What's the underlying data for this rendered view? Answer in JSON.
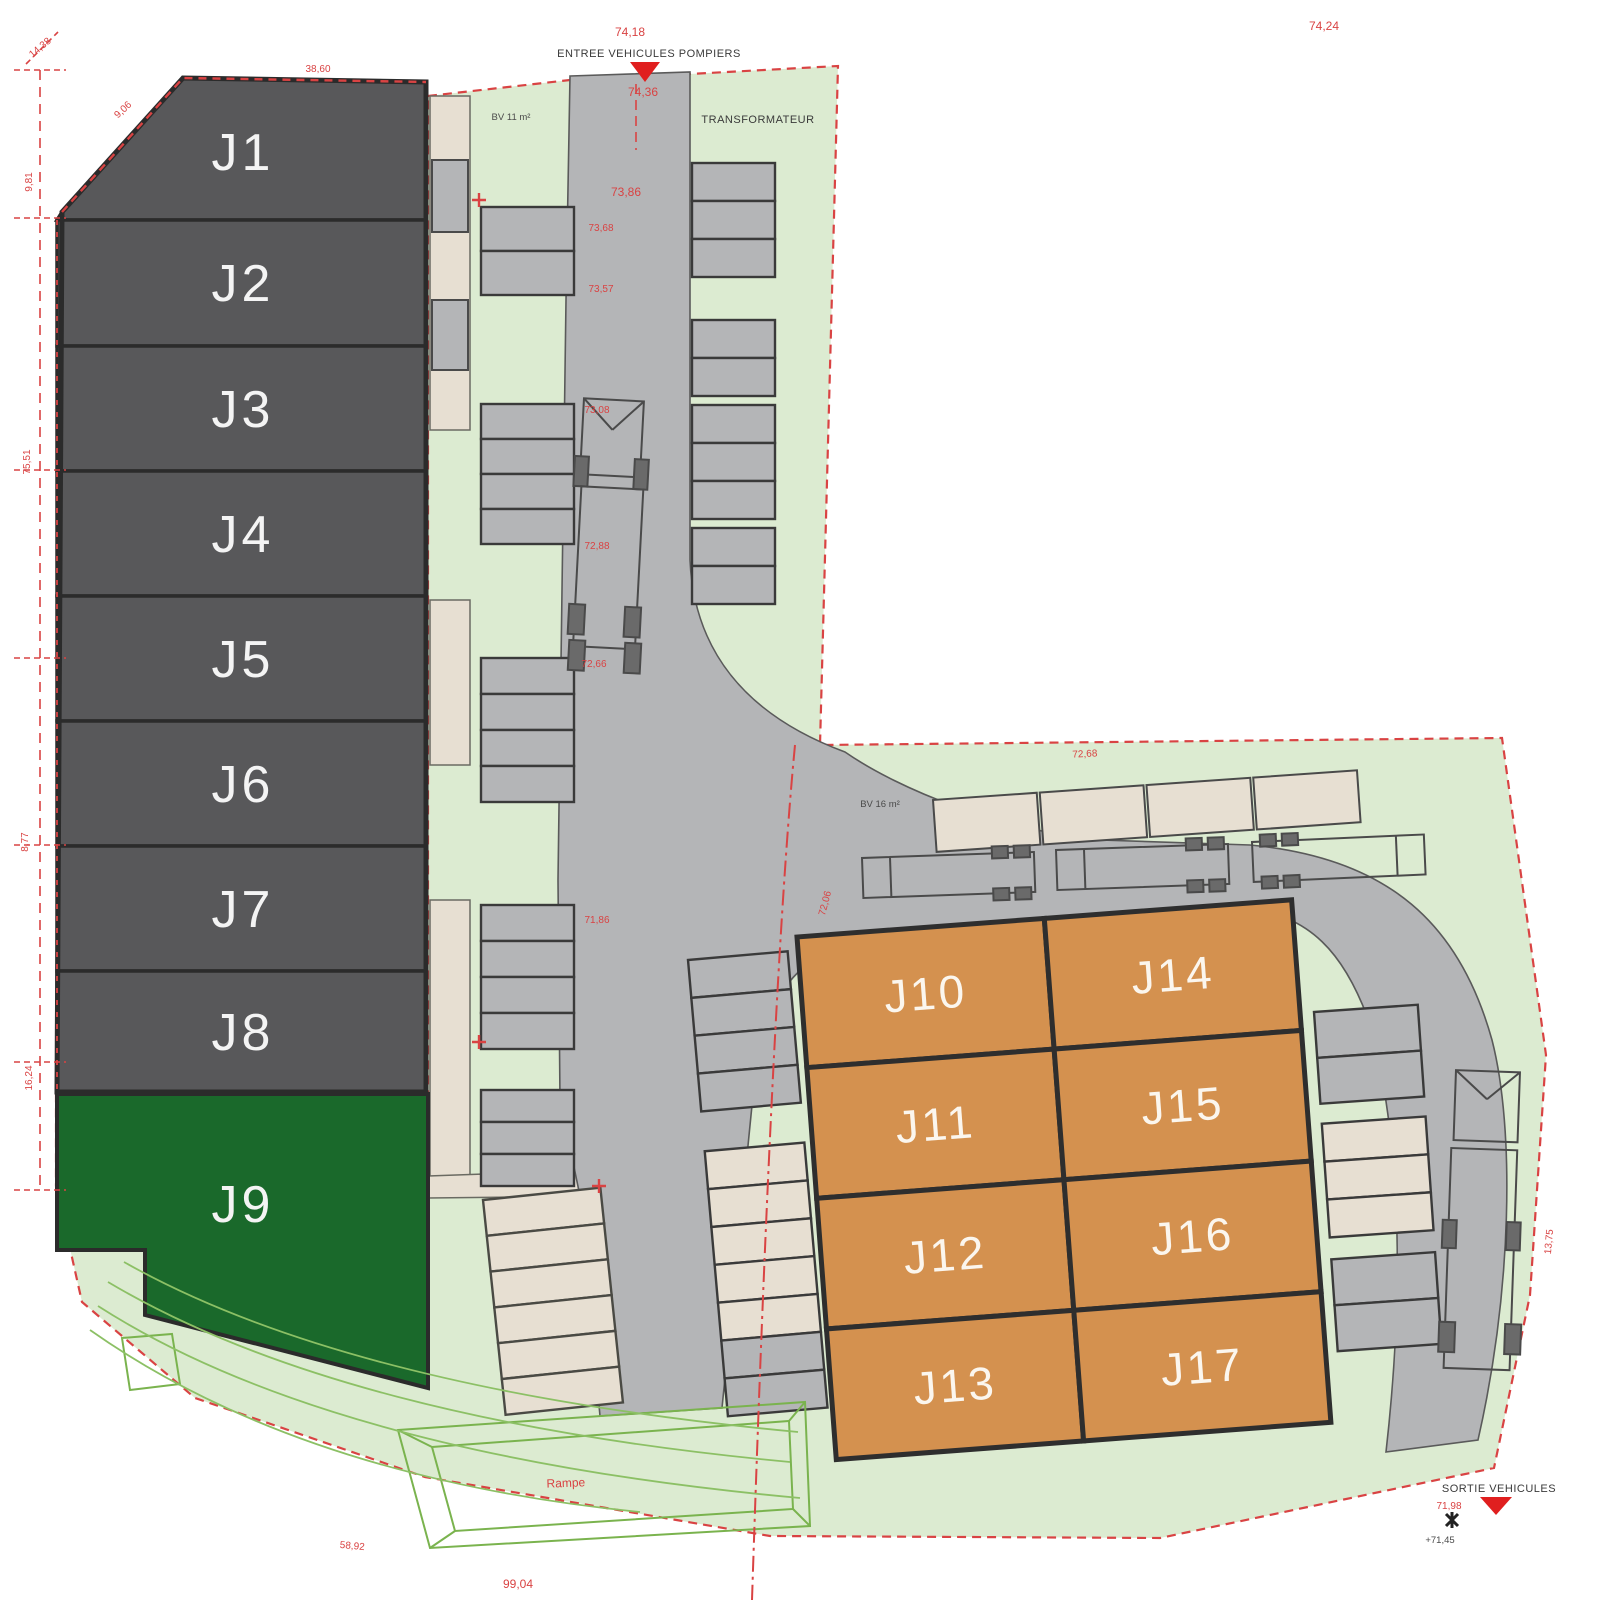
{
  "building": {
    "units": [
      {
        "id": "J1"
      },
      {
        "id": "J2"
      },
      {
        "id": "J3"
      },
      {
        "id": "J4"
      },
      {
        "id": "J5"
      },
      {
        "id": "J6"
      },
      {
        "id": "J7"
      },
      {
        "id": "J8"
      }
    ]
  },
  "green_lot": {
    "id": "J9"
  },
  "plots": [
    {
      "id": "J10"
    },
    {
      "id": "J11"
    },
    {
      "id": "J12"
    },
    {
      "id": "J13"
    },
    {
      "id": "J14"
    },
    {
      "id": "J15"
    },
    {
      "id": "J16"
    },
    {
      "id": "J17"
    }
  ],
  "markers": {
    "entry": {
      "label": "ENTREE VEHICULES POMPIERS"
    },
    "exit": {
      "label": "SORTIE VEHICULES",
      "level": "+71,45"
    }
  },
  "site_labels": {
    "transformer": "TRANSFORMATEUR",
    "utility_left": "BV 11 m²",
    "utility_dock": "BV 16 m²"
  },
  "dimensions": [
    {
      "text": "74,18"
    },
    {
      "text": "74,36"
    },
    {
      "text": "74,24"
    },
    {
      "text": "73,86"
    },
    {
      "text": "73,68"
    },
    {
      "text": "73,57"
    },
    {
      "text": "73,08"
    },
    {
      "text": "72,88"
    },
    {
      "text": "72,66"
    },
    {
      "text": "71,86"
    },
    {
      "text": "72,06"
    },
    {
      "text": "72,68"
    },
    {
      "text": "14,38"
    },
    {
      "text": "9,06"
    },
    {
      "text": "38,60"
    },
    {
      "text": "9,81"
    },
    {
      "text": "75,51"
    },
    {
      "text": "8,77"
    },
    {
      "text": "16,24"
    },
    {
      "text": "99,04"
    },
    {
      "text": "Rampe"
    },
    {
      "text": "58,92"
    },
    {
      "text": "13,75"
    },
    {
      "text": "71,98"
    }
  ],
  "colors": {
    "building": "#58585a",
    "building_edge": "#2b2b2b",
    "lot_green": "#1a692b",
    "lot_orange": "#d4914f",
    "site_green": "#dcebd1",
    "road": "#b4b5b7",
    "stall_beige": "#e7dfd2",
    "annotation_red": "#d94343",
    "wire_green": "#7ab34e"
  }
}
